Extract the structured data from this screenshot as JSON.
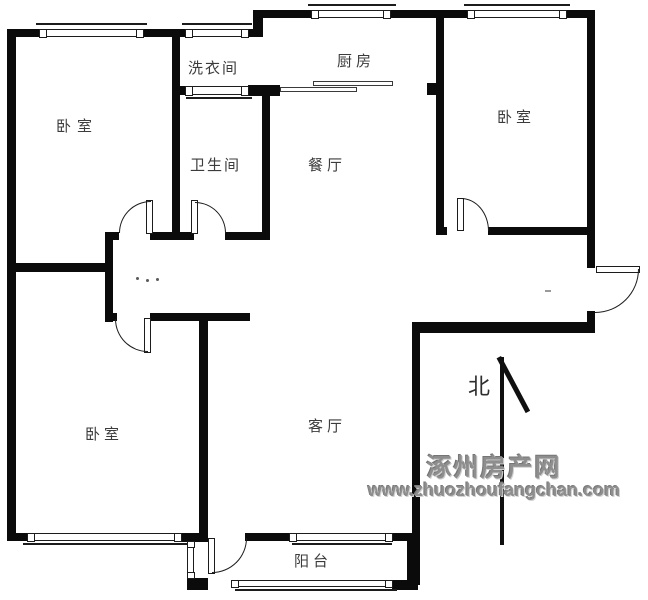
{
  "floorplan": {
    "rooms": {
      "bedroom_nw": "卧室",
      "laundry": "洗衣间",
      "kitchen": "厨房",
      "bedroom_ne": "卧室",
      "bathroom": "卫生间",
      "dining": "餐厅",
      "bedroom_sw": "卧室",
      "living": "客厅",
      "balcony": "阳台"
    },
    "compass": {
      "north_label": "北"
    },
    "watermark": {
      "site_name": "涿州房产网",
      "url": "www.zhuozhoufangchan.com"
    },
    "colors": {
      "wall": "#0b0b0b",
      "line": "#1c1c1c",
      "label": "#3c3c3c",
      "watermark_gray": "#8e8e8e",
      "background": "#ffffff"
    }
  }
}
